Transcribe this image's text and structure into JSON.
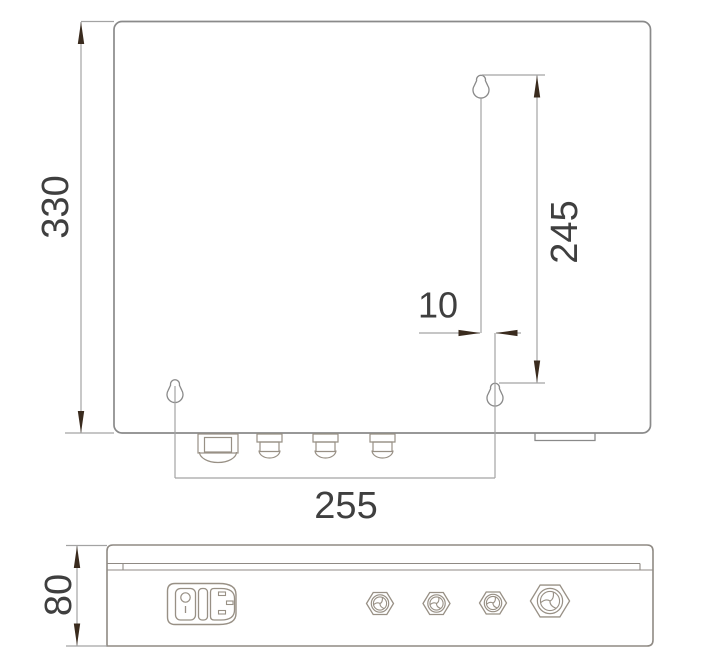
{
  "drawing": {
    "type": "technical-dimension-drawing",
    "views": [
      "top-view-enclosure",
      "side-view-enclosure"
    ],
    "dimensions": {
      "overall_height": "330",
      "mounting_hole_vertical_pitch": "245",
      "mounting_hole_offset": "10",
      "mounting_hole_horizontal_pitch": "255",
      "enclosure_depth": "80"
    },
    "features": {
      "keyhole_slots": 3,
      "top_view_cable_glands": 4,
      "side_view_cable_glands": 4,
      "power_module": "rocker-switch-with-iec-inlet"
    },
    "colors": {
      "background": "#ffffff",
      "geometry_line": "#8a8a8a",
      "dimension_line": "#a3a3a3",
      "arrow": "#3a2b1e",
      "component_line": "#989085",
      "text": "#3f3f3f"
    }
  }
}
